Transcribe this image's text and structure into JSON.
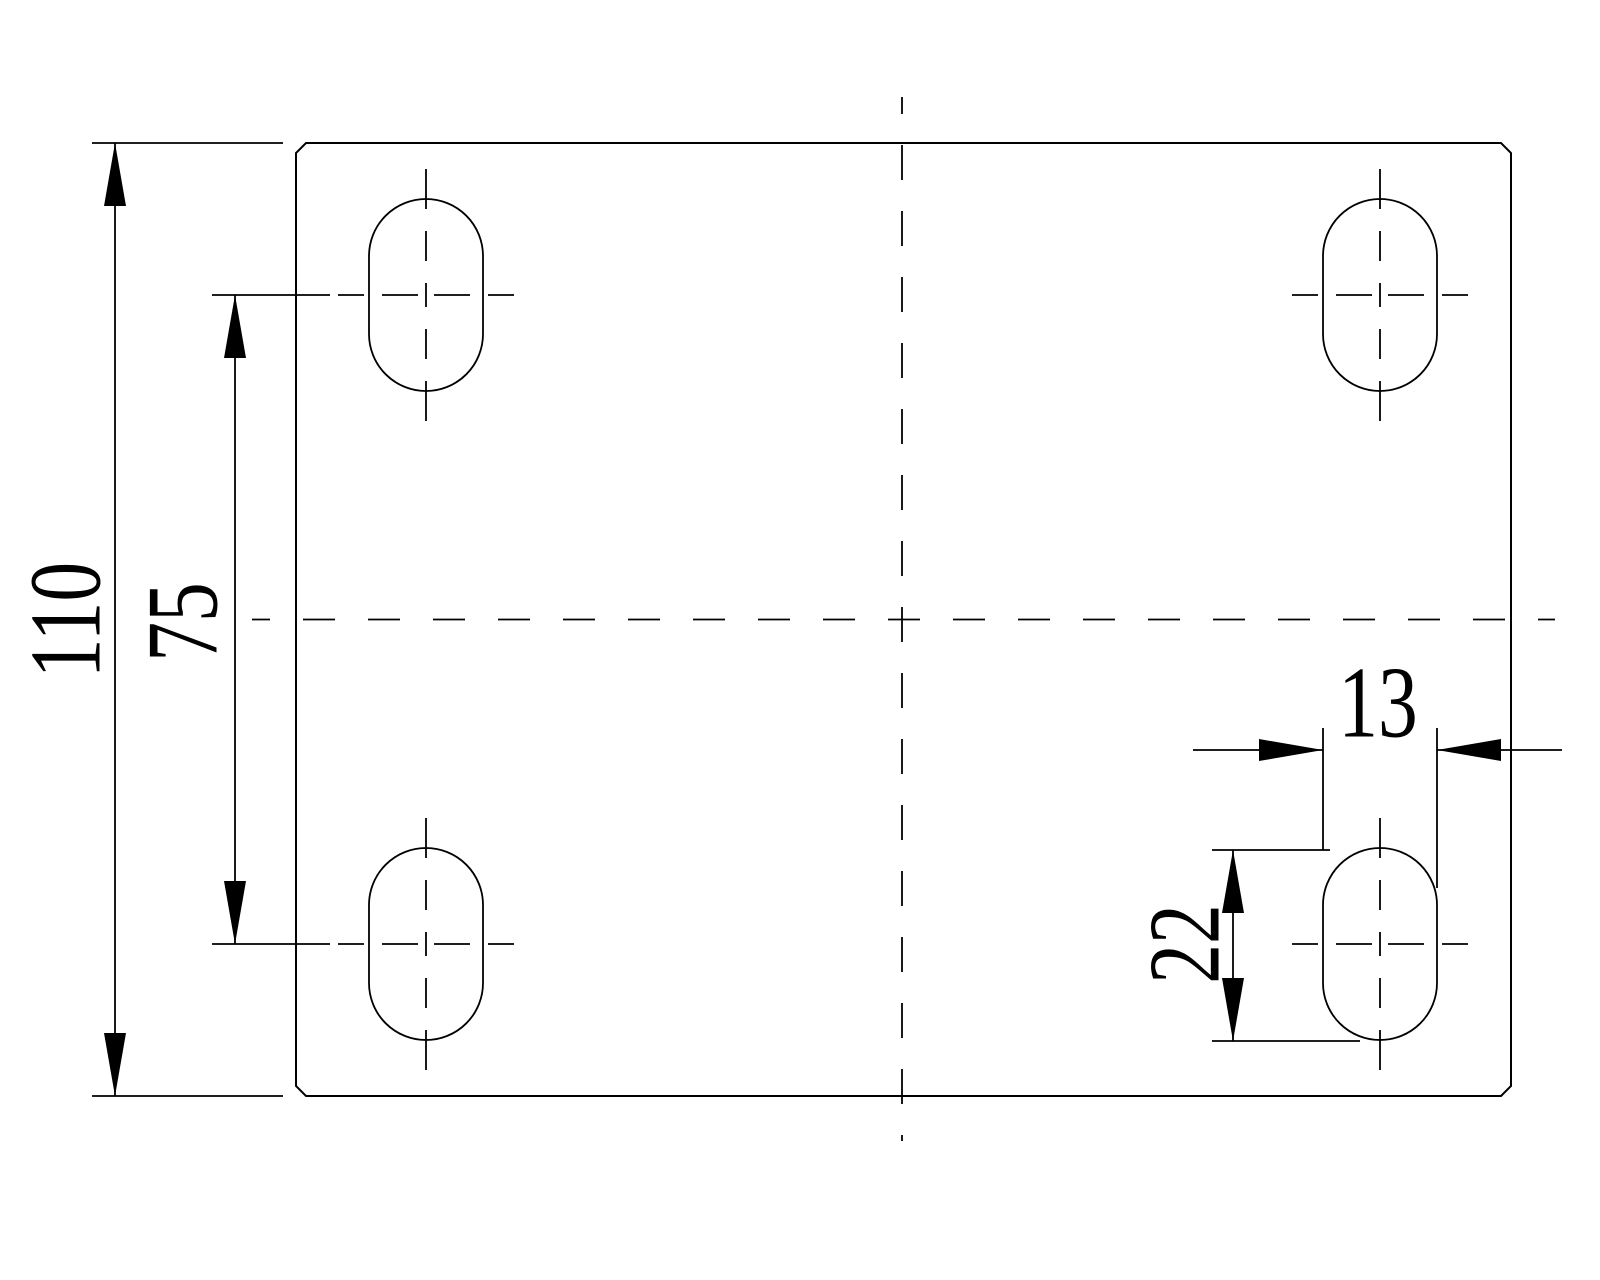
{
  "drawing": {
    "background_color": "#ffffff",
    "line_color": "#000000",
    "dimensions": {
      "overall_height": "110",
      "row_spacing": "75",
      "slot_width": "13",
      "slot_length": "22"
    }
  }
}
